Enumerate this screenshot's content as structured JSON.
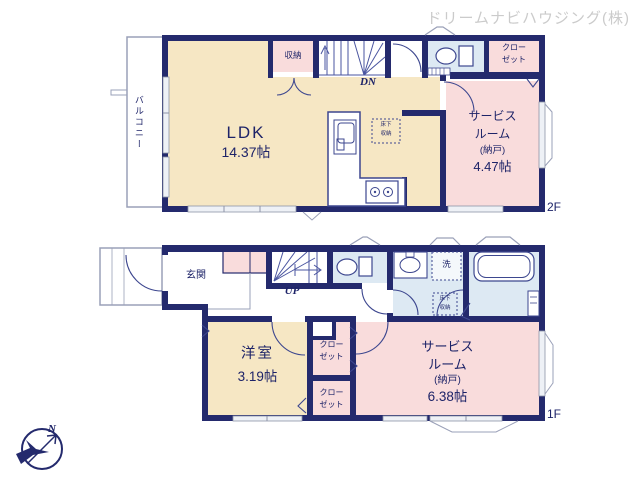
{
  "company": "ドリームナビハウジング(株)",
  "compass": {
    "north": "N"
  },
  "colors": {
    "wall_navy": "#242a6d",
    "fixture_line": "#3d478f",
    "room_yellow": "#f6e7c4",
    "room_pink": "#f9dcdc",
    "room_blue": "#dde9f3",
    "outline_gray": "#9aa0b8",
    "title_gray": "#cbcbcb",
    "text_navy": "#1d2368"
  },
  "floor2": {
    "floor_label": "2F",
    "balcony": "バルコニー",
    "ldk_name": "LDK",
    "ldk_size": "14.37帖",
    "storage": "収納",
    "stair_label": "DN",
    "closet": {
      "line1": "クロー",
      "line2": "ゼット"
    },
    "service": {
      "line1": "サービス",
      "line2": "ルーム",
      "line3": "(納戸)",
      "size": "4.47帖"
    },
    "underfloor": {
      "line1": "床下",
      "line2": "収納"
    }
  },
  "floor1": {
    "floor_label": "1F",
    "entrance": "玄関",
    "stair_label": "UP",
    "laundry": "洗",
    "underfloor": {
      "line1": "床下",
      "line2": "収納"
    },
    "western": {
      "name": "洋室",
      "size": "3.19帖"
    },
    "closet_upper": {
      "line1": "クロー",
      "line2": "ゼット"
    },
    "closet_lower": {
      "line1": "クロー",
      "line2": "ゼット"
    },
    "service": {
      "line1": "サービス",
      "line2": "ルーム",
      "line3": "(納戸)",
      "size": "6.38帖"
    }
  }
}
